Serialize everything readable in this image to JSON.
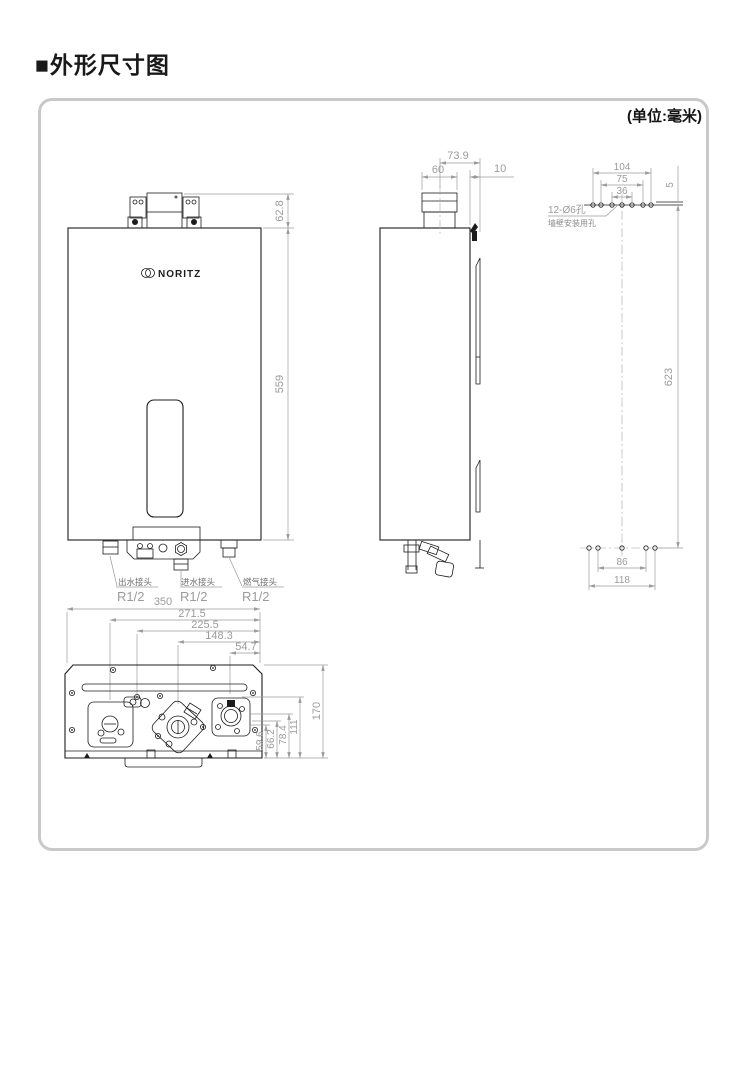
{
  "page": {
    "title": "■外形尺寸图",
    "unit_note": "(单位:毫米)"
  },
  "colors": {
    "object_line": "#1c1c1c",
    "dimension": "#9b9b9b",
    "panel_border": "#c9c9c9",
    "label": "#6e6e6e"
  },
  "front_view": {
    "brand": "NORITZ",
    "bracket_height": "62.8",
    "body_height": "559",
    "connections": [
      {
        "name": "出水接头",
        "thread": "R1/2"
      },
      {
        "name": "进水接头",
        "thread": "R1/2"
      },
      {
        "name": "燃气接头",
        "thread": "R1/2"
      }
    ]
  },
  "side_view": {
    "flue_offset": "73.9",
    "flue_width": "60",
    "wall_gap": "10"
  },
  "rear_view": {
    "hole_note_line1": "12-Ø6孔",
    "hole_note_line2": "墙壁安装用孔",
    "top_widths": [
      "104",
      "75",
      "36"
    ],
    "top_edge_gap": "5",
    "hole_span_height": "623",
    "bottom_widths": [
      "86",
      "118"
    ]
  },
  "bottom_view": {
    "widths": [
      "350",
      "271.5",
      "225.5",
      "148.3",
      "54.7"
    ],
    "depths": [
      "59.6",
      "66.2",
      "78.4",
      "111",
      "170"
    ]
  }
}
